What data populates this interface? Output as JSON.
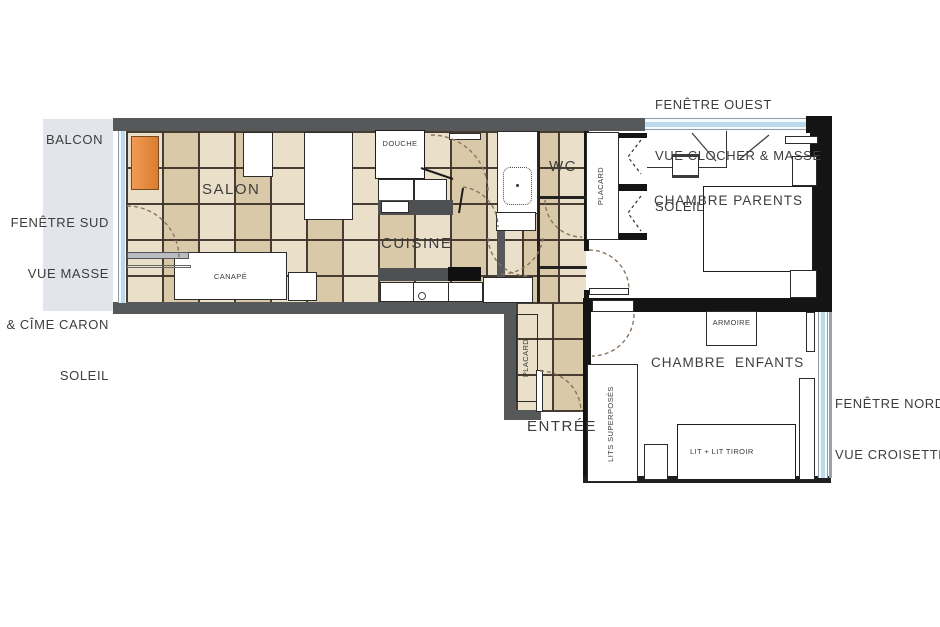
{
  "plan": {
    "balcony_label": "BALCON",
    "entrance_label": "ENTRÉE",
    "rooms": {
      "salon": "SALON",
      "cuisine": "CUISINE",
      "douche": "DOUCHE",
      "wc": "WC",
      "chambre_parents": "CHAMBRE PARENTS",
      "chambre_enfants": "CHAMBRE  ENFANTS"
    },
    "furniture": {
      "canape": "CANAPÉ",
      "placard_hall": "PLACARD",
      "placard_parents": "PLACARD",
      "armoire": "ARMOIRE",
      "lits_superposes": "LITS SUPERPOSÉS",
      "lit_tiroir": "LIT + LIT TIROIR"
    },
    "annotations": {
      "south": {
        "lines": [
          "FENÊTRE SUD",
          "VUE MASSE",
          "& CÎME CARON",
          "SOLEIL"
        ]
      },
      "west": {
        "lines": [
          "FENÊTRE OUEST",
          "VUE CLOCHER & MASSE",
          "SOLEIL"
        ]
      },
      "north": {
        "lines": [
          "FENÊTRE NORD",
          "VUE CROISETTE"
        ]
      }
    },
    "colors": {
      "tile_beige": "#e3d4b6",
      "grout_brown": "#3e352a",
      "wall_gray": "#57585a",
      "wall_black": "#141414",
      "window_blue": "#bcdaea",
      "balcony_gray": "#e2e5eb",
      "accent_orange": "#e3873c",
      "text_gray": "#3d3d3d"
    }
  }
}
